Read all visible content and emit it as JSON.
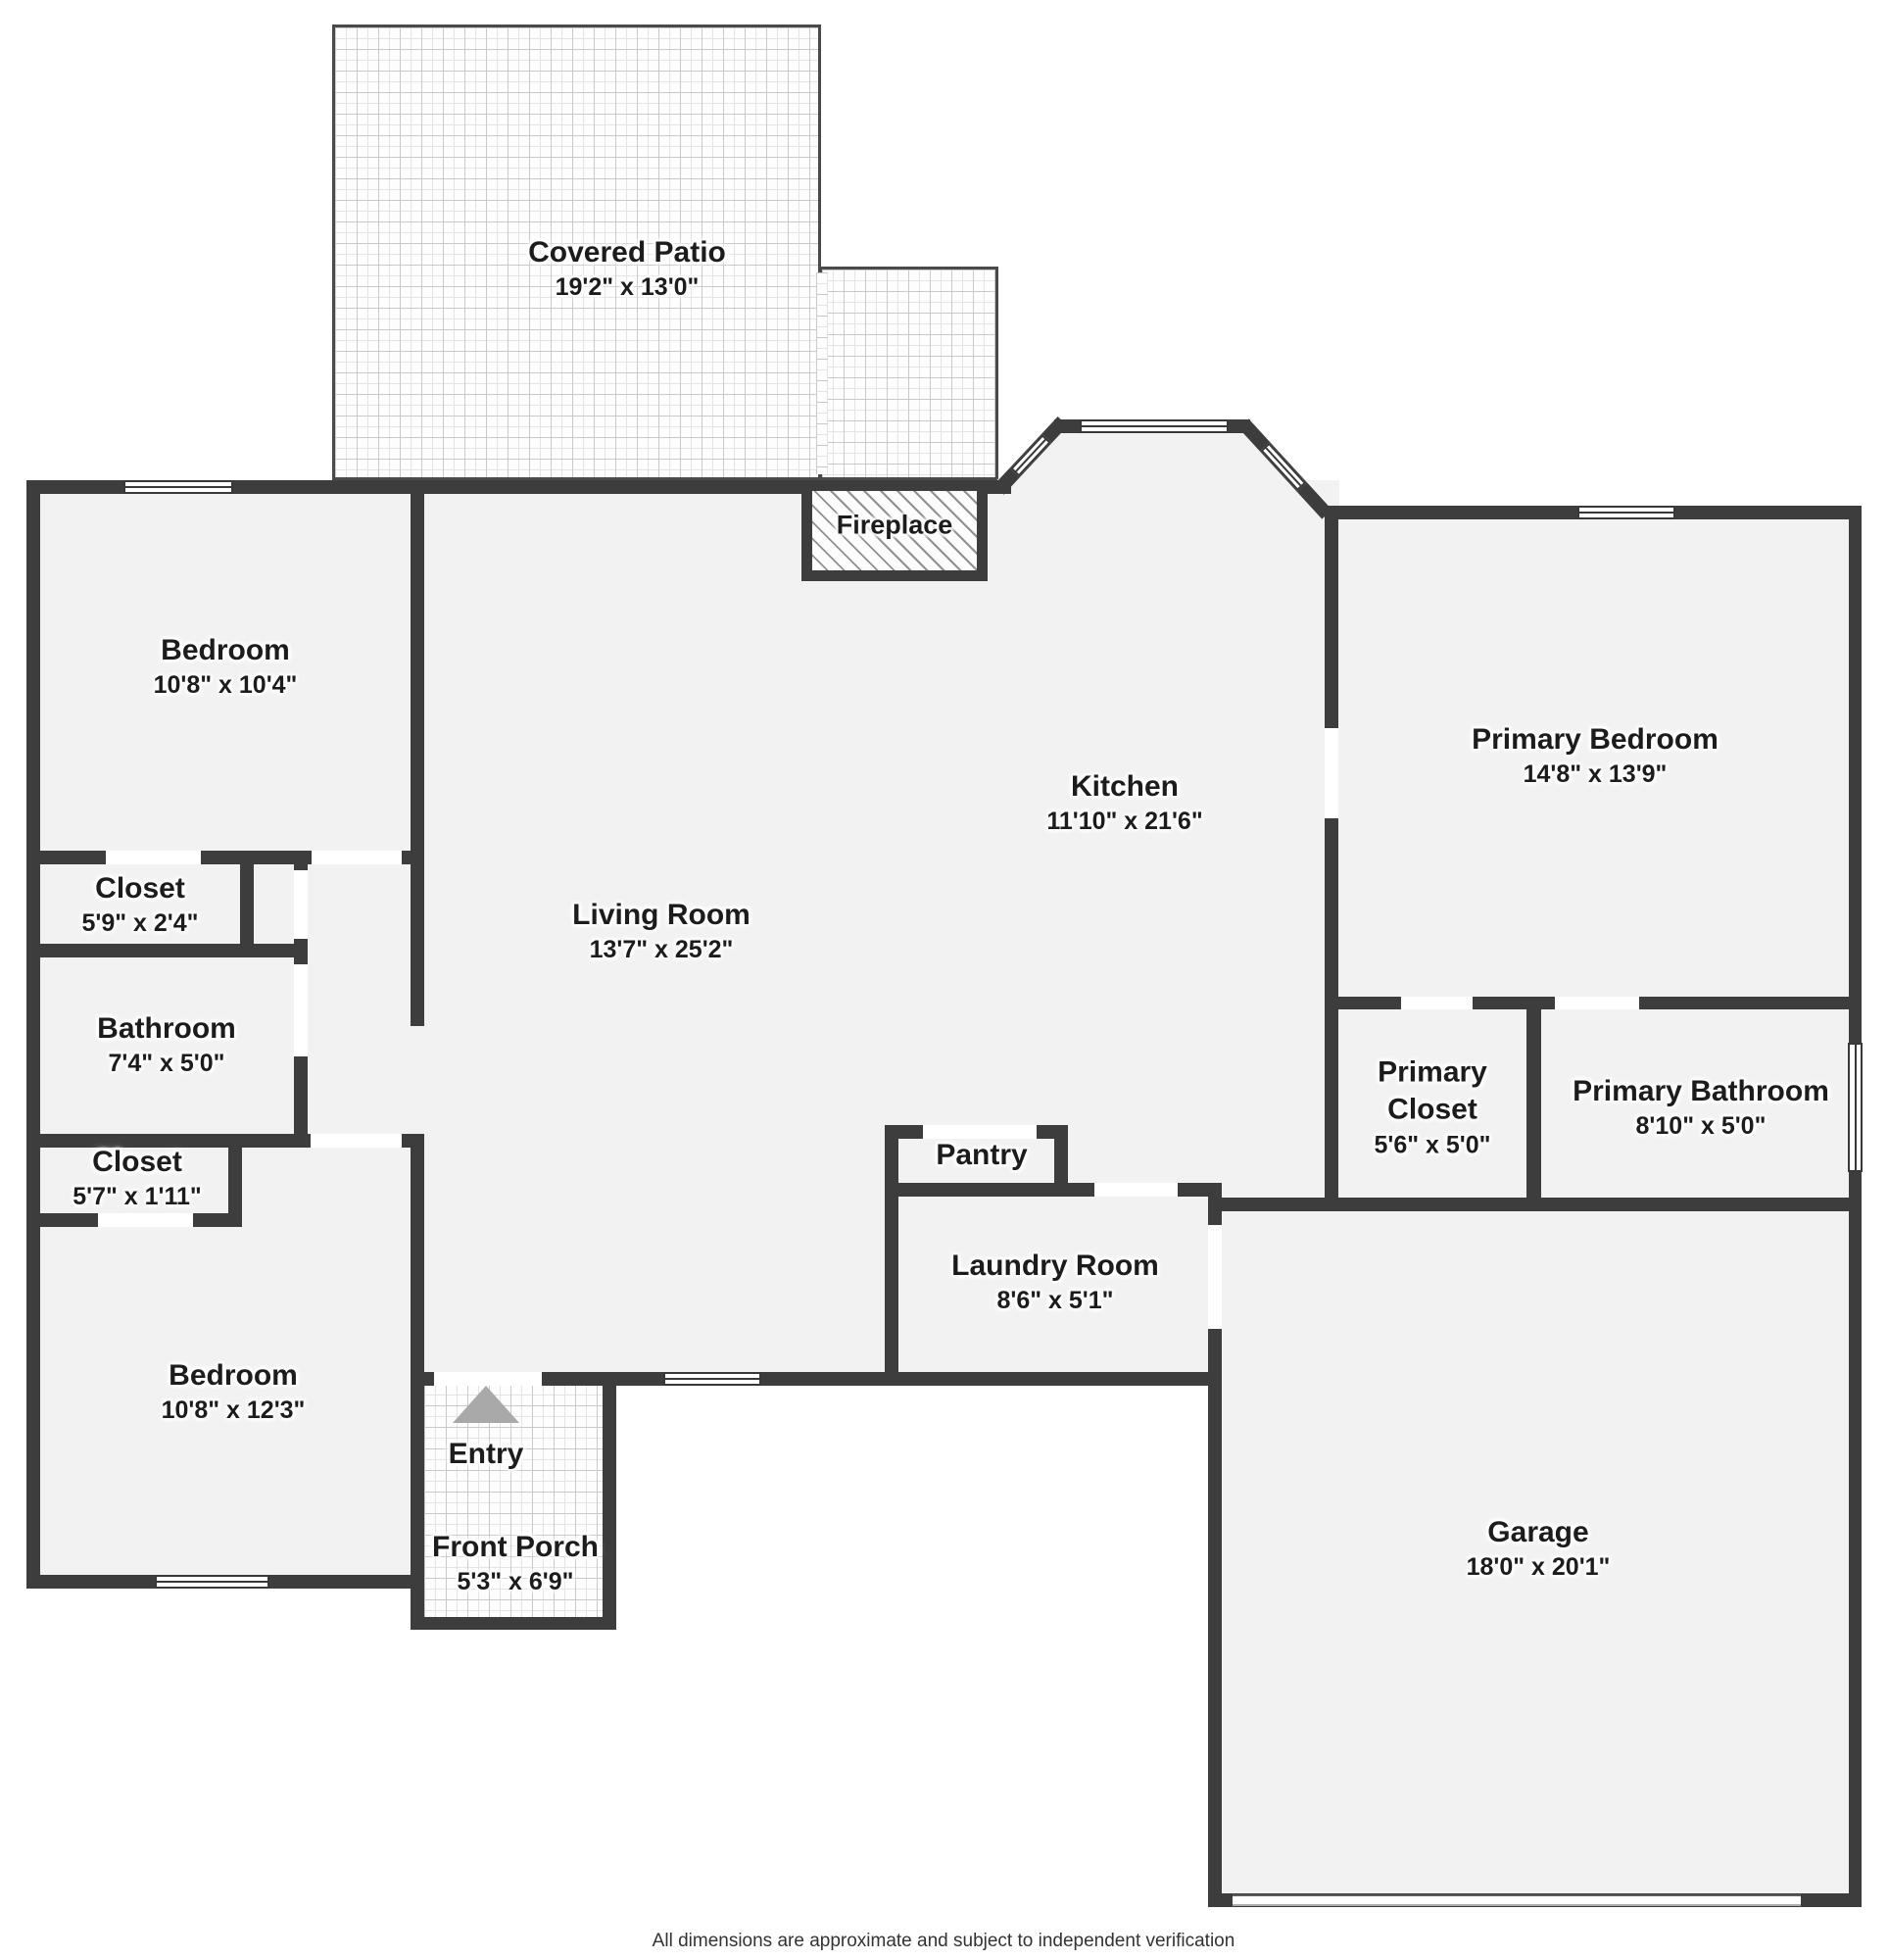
{
  "colors": {
    "wall": "#3d3d3d",
    "floor": "#f2f2f2",
    "background": "#ffffff",
    "label_text": "#1c1c1c",
    "entry_arrow": "#a9a9a9"
  },
  "rooms": {
    "covered_patio": {
      "name": "Covered Patio",
      "dims": "19'2\" x 13'0\""
    },
    "fireplace": {
      "name": "Fireplace"
    },
    "bedroom_top": {
      "name": "Bedroom",
      "dims": "10'8\" x 10'4\""
    },
    "kitchen": {
      "name": "Kitchen",
      "dims": "11'10\" x 21'6\""
    },
    "primary_bedroom": {
      "name": "Primary Bedroom",
      "dims": "14'8\" x 13'9\""
    },
    "closet_top": {
      "name": "Closet",
      "dims": "5'9\" x 2'4\""
    },
    "living_room": {
      "name": "Living Room",
      "dims": "13'7\" x 25'2\""
    },
    "bathroom": {
      "name": "Bathroom",
      "dims": "7'4\" x 5'0\""
    },
    "primary_closet": {
      "name": "Primary Closet",
      "dims": "5'6\" x 5'0\""
    },
    "primary_bathroom": {
      "name": "Primary Bathroom",
      "dims": "8'10\" x 5'0\""
    },
    "closet_bottom": {
      "name": "Closet",
      "dims": "5'7\" x 1'11\""
    },
    "pantry": {
      "name": "Pantry"
    },
    "laundry_room": {
      "name": "Laundry Room",
      "dims": "8'6\" x 5'1\""
    },
    "bedroom_bottom": {
      "name": "Bedroom",
      "dims": "10'8\" x 12'3\""
    },
    "entry": {
      "name": "Entry"
    },
    "front_porch": {
      "name": "Front Porch",
      "dims": "5'3\" x 6'9\""
    },
    "garage": {
      "name": "Garage",
      "dims": "18'0\" x 20'1\""
    }
  },
  "footer": {
    "disclaimer": "All dimensions are approximate and subject to independent verification"
  }
}
